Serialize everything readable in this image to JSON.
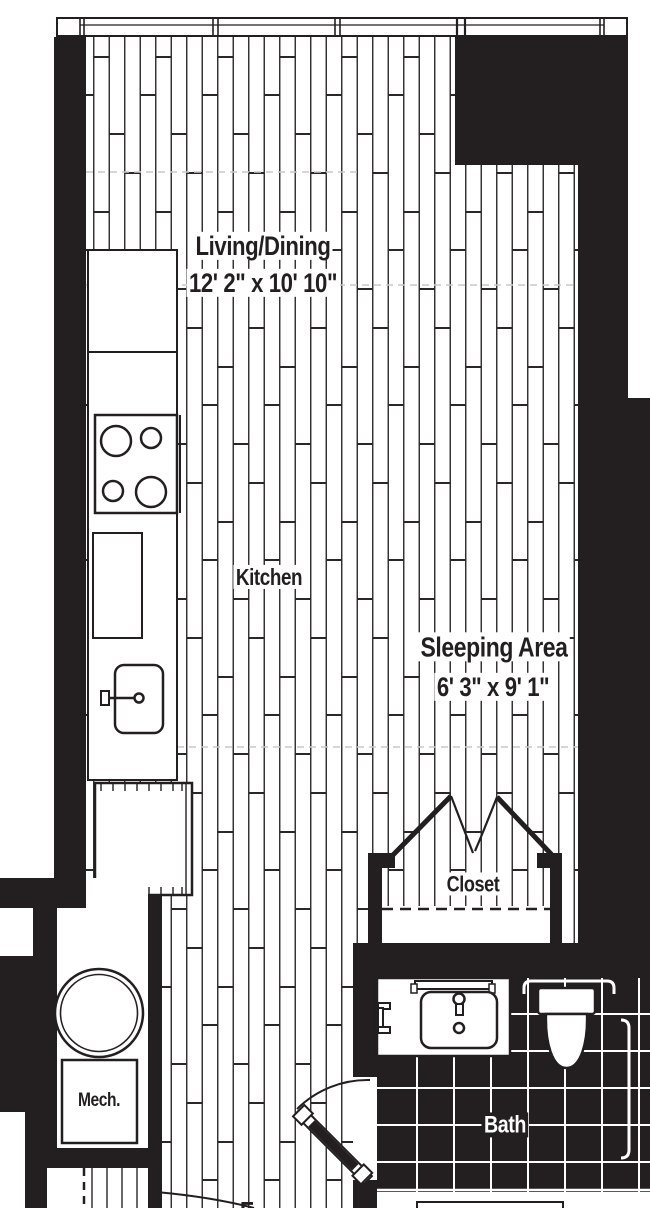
{
  "floorplan": {
    "title": "Studio apartment floor plan",
    "labels": {
      "living_dining": "Living/Dining",
      "living_dining_dims": "12' 2\" x 10' 10\"",
      "kitchen": "Kitchen",
      "sleeping_area": "Sleeping Area",
      "sleeping_area_dims": "6' 3\" x 9' 1\"",
      "closet": "Closet",
      "mech": "Mech.",
      "bath": "Bath",
      "entry_fragment": "E"
    },
    "fixtures": [
      "window-band",
      "stove-burners",
      "kitchen-counter",
      "kitchen-sink",
      "appliance-unit",
      "water-heater",
      "mech-box",
      "bifold-closet-doors",
      "closet-shelf-dashed",
      "bath-swing-door",
      "entry-swing-door",
      "vanity-sink",
      "mirror-bar",
      "toilet",
      "towel-bar-top",
      "towel-bar-right",
      "tile-floor",
      "wood-plank-floor",
      "entry-closet-rod"
    ],
    "colors": {
      "wall": "#231f20",
      "floor_line": "#2b2728",
      "tile": "#231f20",
      "tile_grout": "#ffffff",
      "soffit_dash": "#c9c9c9",
      "background": "#ffffff"
    }
  }
}
